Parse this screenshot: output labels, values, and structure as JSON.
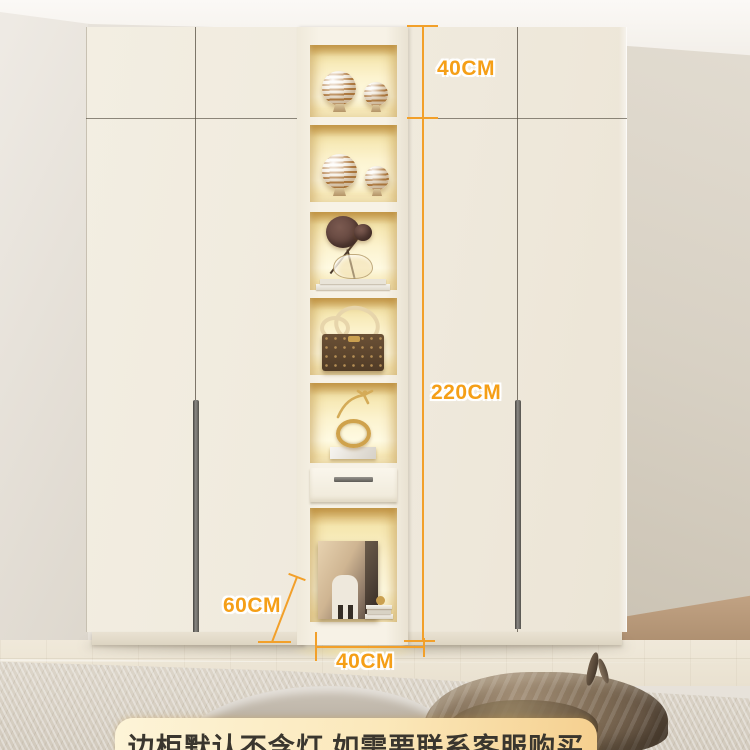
{
  "labels": {
    "top_height": "40CM",
    "total_height": "220CM",
    "depth": "60CM",
    "column_width": "40CM"
  },
  "banner": {
    "text": "边柜默认不含灯 如需要联系客服购买"
  },
  "colors": {
    "measure_orange": "#F2A02A",
    "label_orange": "#F59F17",
    "cabinet_cream": "#F1ECDF",
    "interior_glow": "#FCF3CF",
    "banner_gradient_start": "#FDF4D8",
    "banner_gradient_end": "#F5CF8E",
    "banner_text": "#3A362E"
  },
  "scene": {
    "description": "cream wardrobe with central lit display column",
    "shelf_items": [
      "striped-ornament-balls",
      "striped-ornament-balls",
      "dried-flower-vase-on-books",
      "monogram-handbag",
      "gold-ring-sculpture",
      "drawer",
      "framed-artwork-with-books"
    ]
  }
}
